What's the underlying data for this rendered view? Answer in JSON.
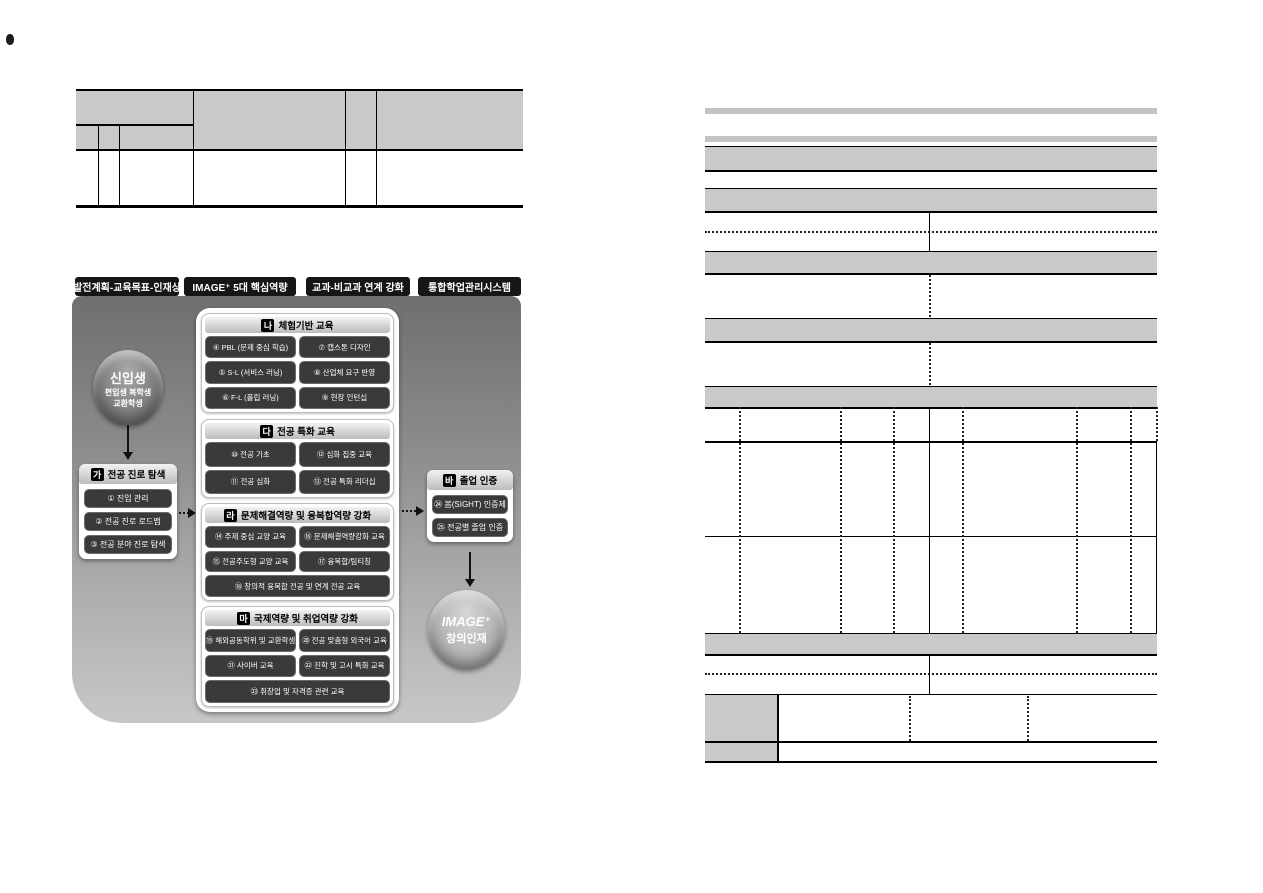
{
  "left_page": {
    "diagram": {
      "tabs": [
        "발전계획-교육목표-인재상",
        "IMAGE⁺ 5대 핵심역량",
        "교과-비교과 연계 강화",
        "통합학업관리시스템"
      ],
      "entry_circle": {
        "line1": "신입생",
        "line2": "편입생 복학생",
        "line3": "교환학생"
      },
      "ga": {
        "badge": "가",
        "title": "전공 진로 탐색",
        "items": [
          "① 진입 관리",
          "② 전공 진로 로드맵",
          "③ 전공 분야 진로 탐색"
        ]
      },
      "na": {
        "badge": "나",
        "title": "체험기반 교육",
        "items": [
          "④ PBL (문제 중심 학습)",
          "⑦ 캡스톤 디자인",
          "⑤ S-L (서비스 러닝)",
          "⑧ 산업체 요구 반영",
          "⑥ F-L (플립 러닝)",
          "⑨ 현장 인턴십"
        ]
      },
      "da": {
        "badge": "다",
        "title": "전공 특화 교육",
        "items": [
          "⑩ 전공 기초",
          "⑫ 심화 집중 교육",
          "⑪ 전공 심화",
          "⑬ 전공 특화 리더십"
        ]
      },
      "ra": {
        "badge": "라",
        "title": "문제해결역량 및 융복합역량 강화",
        "items": [
          "⑭ 주제 중심 교양 교육",
          "⑯ 문제해결역량강화 교육",
          "⑮ 전공주도형 교양 교육",
          "⑰ 융복합/팀티칭"
        ],
        "wide_item": "⑱ 창의적 융복합 전공 및 연계 전공 교육"
      },
      "ma": {
        "badge": "마",
        "title": "국제역량 및 취업역량 강화",
        "items": [
          "⑲ 해외공동학위 및 교환학생",
          "⑳ 전공 맞춤형 외국어 교육",
          "㉑ 사이버 교육",
          "㉒ 진학 및 고시 특화 교육"
        ],
        "wide_item": "㉓ 취창업 및 자격증 관련 교육"
      },
      "ba": {
        "badge": "바",
        "title": "졸업 인증",
        "items": [
          "㉔ 봄(SIGHT) 인증제",
          "㉕ 전공별 졸업 인증"
        ]
      },
      "result_circle": {
        "line1": "IMAGE⁺",
        "line2": "창의인재"
      }
    }
  },
  "colors": {
    "table_grey": "#c9c9c9",
    "tab_black": "#161616",
    "panel_top_grey": "#6f6f6f",
    "panel_bottom_grey": "#c7c7c7",
    "button_dark": "#3a3a3a"
  }
}
